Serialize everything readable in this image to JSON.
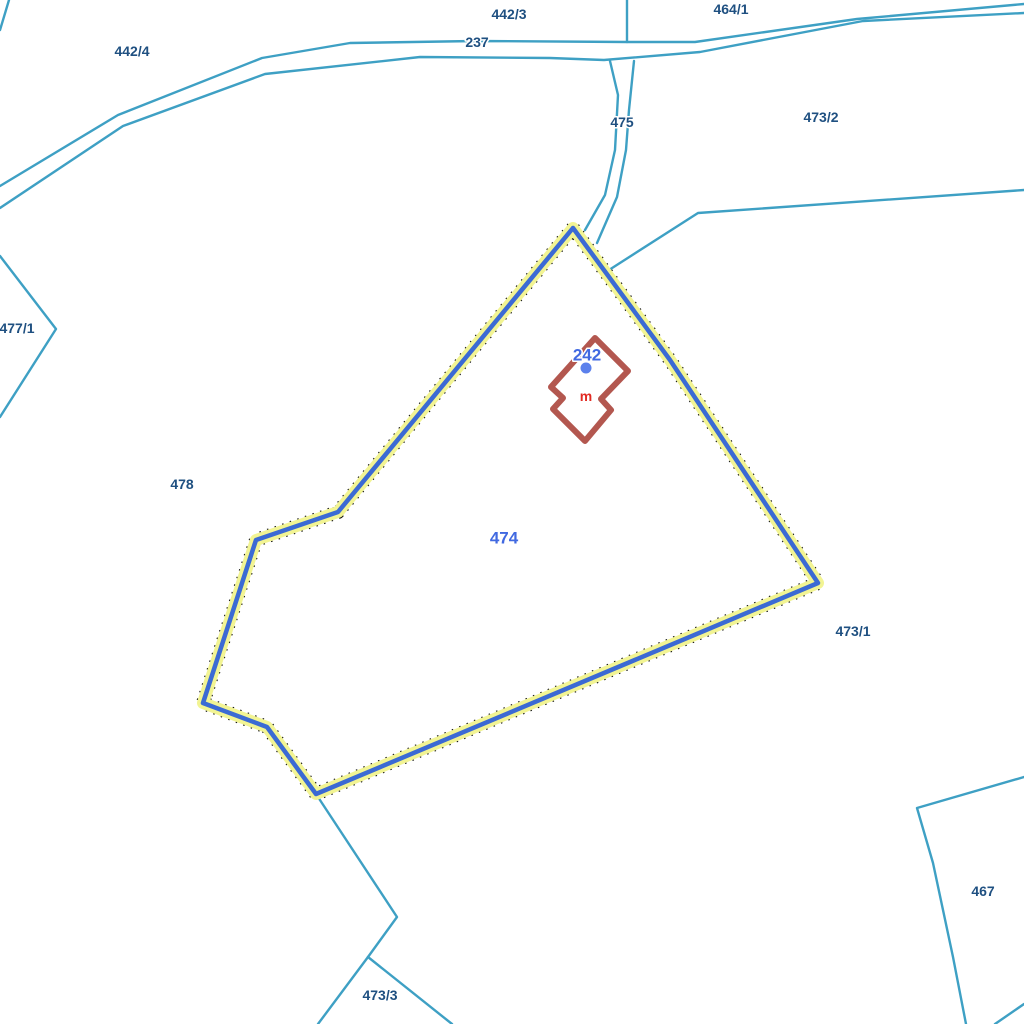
{
  "map": {
    "background": "#ffffff",
    "colors": {
      "parcel_line": "#3ea0c4",
      "label_ref": "#1f5081",
      "label_selected": "#4169e1",
      "label_building_use": "#e22a22",
      "highlight_core": "#3b6ad4",
      "highlight_halo": "#f2f493",
      "building_outline": "#b3574f",
      "point_marker": "#5b80ec"
    },
    "lines": [
      {
        "name": "road-237-upper",
        "points": [
          [
            0,
            186
          ],
          [
            118,
            115
          ],
          [
            262,
            58
          ],
          [
            350,
            43
          ],
          [
            475,
            41
          ],
          [
            627,
            42
          ],
          [
            695,
            42
          ],
          [
            857,
            19
          ],
          [
            1024,
            4
          ]
        ]
      },
      {
        "name": "road-237-lower",
        "points": [
          [
            0,
            208
          ],
          [
            123,
            126
          ],
          [
            265,
            74
          ],
          [
            420,
            57
          ],
          [
            550,
            58
          ],
          [
            604,
            60
          ],
          [
            700,
            52
          ],
          [
            863,
            21
          ],
          [
            1024,
            13
          ]
        ]
      },
      {
        "name": "corner-line-top-left",
        "points": [
          [
            9,
            0
          ],
          [
            0,
            30
          ]
        ]
      },
      {
        "name": "divider-442-3-464-1",
        "points": [
          [
            627,
            0
          ],
          [
            627,
            42
          ]
        ]
      },
      {
        "name": "path-475-left",
        "points": [
          [
            610,
            61
          ],
          [
            618,
            95
          ],
          [
            615,
            150
          ],
          [
            605,
            195
          ],
          [
            585,
            230
          ]
        ]
      },
      {
        "name": "path-475-right",
        "points": [
          [
            634,
            61
          ],
          [
            629,
            110
          ],
          [
            626,
            150
          ],
          [
            617,
            197
          ],
          [
            597,
            243
          ]
        ]
      },
      {
        "name": "boundary-473-2",
        "points": [
          [
            609,
            270
          ],
          [
            698,
            213
          ],
          [
            1024,
            190
          ]
        ]
      },
      {
        "name": "boundary-477-1",
        "points": [
          [
            0,
            256
          ],
          [
            56,
            329
          ],
          [
            0,
            417
          ]
        ]
      },
      {
        "name": "boundary-473-3-north",
        "points": [
          [
            316,
            794
          ],
          [
            397,
            917
          ],
          [
            368,
            957
          ]
        ]
      },
      {
        "name": "boundary-473-3-west",
        "points": [
          [
            368,
            957
          ],
          [
            318,
            1024
          ]
        ]
      },
      {
        "name": "boundary-473-3-east",
        "points": [
          [
            368,
            957
          ],
          [
            452,
            1024
          ]
        ]
      },
      {
        "name": "boundary-467",
        "points": [
          [
            1024,
            777
          ],
          [
            917,
            808
          ],
          [
            933,
            863
          ],
          [
            953,
            957
          ],
          [
            966,
            1024
          ]
        ]
      },
      {
        "name": "boundary-467-corner",
        "points": [
          [
            995,
            1024
          ],
          [
            1024,
            1004
          ]
        ]
      }
    ],
    "highlighted_parcel": {
      "number": "474",
      "polygon": [
        [
          573,
          228
        ],
        [
          338,
          512
        ],
        [
          256,
          540
        ],
        [
          203,
          703
        ],
        [
          267,
          727
        ],
        [
          316,
          794
        ],
        [
          818,
          583
        ],
        [
          670,
          360
        ]
      ]
    },
    "building": {
      "number": "242",
      "use_label": "m",
      "polygon": [
        [
          595,
          338
        ],
        [
          628,
          371
        ],
        [
          601,
          399
        ],
        [
          611,
          410
        ],
        [
          585,
          441
        ],
        [
          553,
          409
        ],
        [
          563,
          398
        ],
        [
          551,
          387
        ]
      ],
      "marker": {
        "x": 586,
        "y": 368,
        "r": 5.5
      }
    },
    "labels": [
      {
        "text": "442/4",
        "x": 132,
        "y": 51,
        "cls": "ref"
      },
      {
        "text": "442/3",
        "x": 509,
        "y": 14,
        "cls": "ref"
      },
      {
        "text": "237",
        "x": 477,
        "y": 42,
        "cls": "ref"
      },
      {
        "text": "464/1",
        "x": 731,
        "y": 9,
        "cls": "ref"
      },
      {
        "text": "475",
        "x": 622,
        "y": 122,
        "cls": "ref"
      },
      {
        "text": "473/2",
        "x": 821,
        "y": 117,
        "cls": "ref"
      },
      {
        "text": "477/1",
        "x": 17,
        "y": 328,
        "cls": "ref"
      },
      {
        "text": "478",
        "x": 182,
        "y": 484,
        "cls": "ref"
      },
      {
        "text": "473/1",
        "x": 853,
        "y": 631,
        "cls": "ref"
      },
      {
        "text": "467",
        "x": 983,
        "y": 891,
        "cls": "ref"
      },
      {
        "text": "473/3",
        "x": 380,
        "y": 995,
        "cls": "ref"
      },
      {
        "text": "474",
        "x": 504,
        "y": 538,
        "cls": "sel"
      },
      {
        "text": "242",
        "x": 587,
        "y": 355,
        "cls": "sel"
      },
      {
        "text": "m",
        "x": 586,
        "y": 396,
        "cls": "red"
      }
    ]
  }
}
